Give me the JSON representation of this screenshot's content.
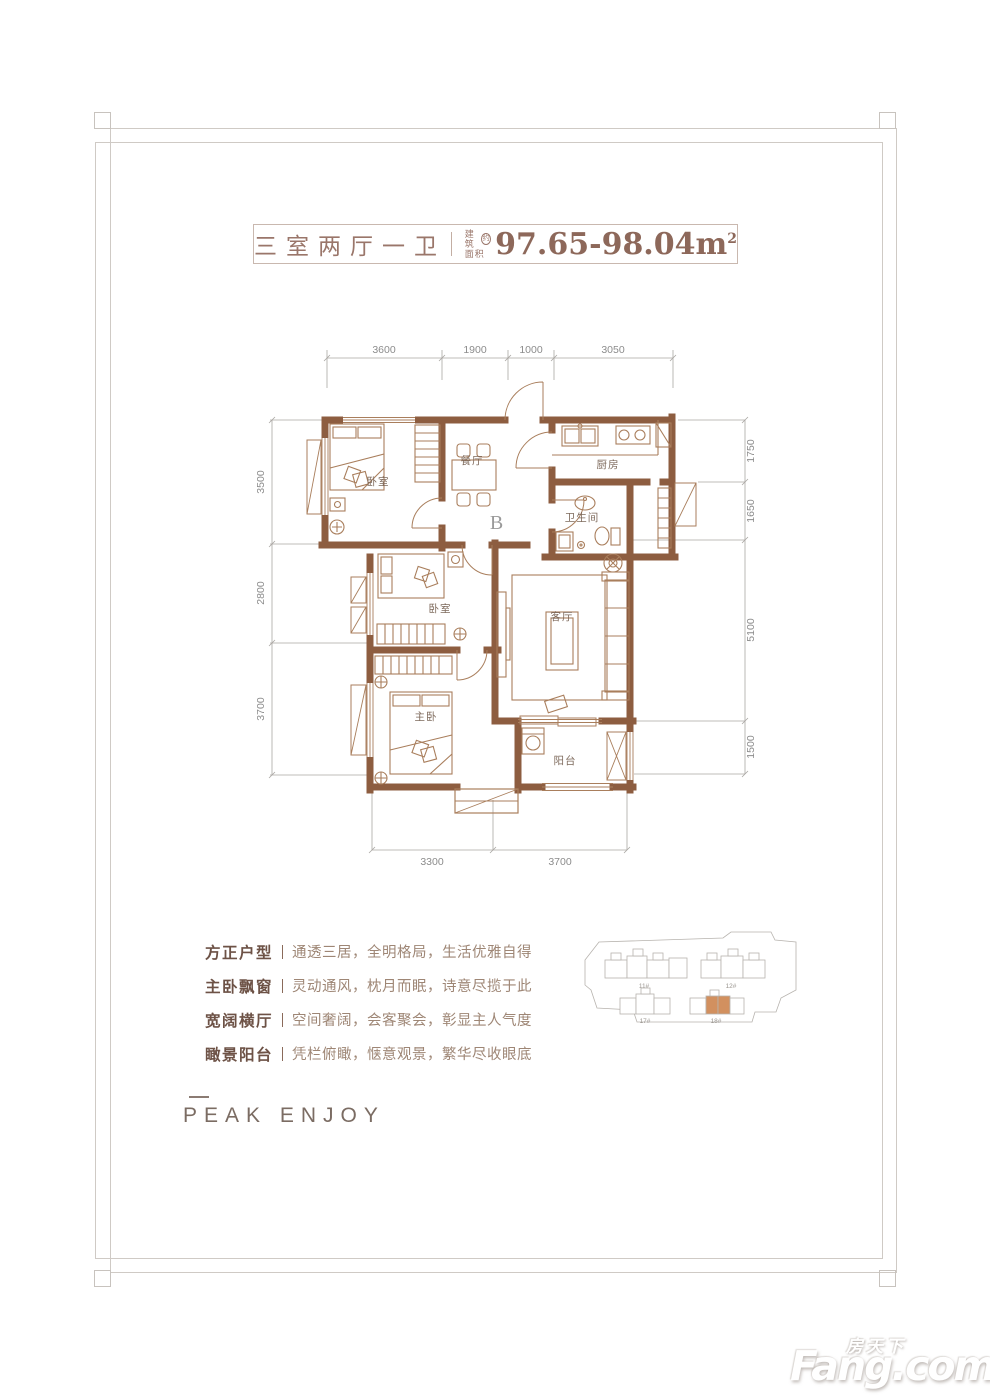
{
  "banner": {
    "title": "三室两厅一卫",
    "area_label_line1": "建筑",
    "area_label_line2": "面积",
    "area_approx": "约",
    "area_value": "97.65-98.04m",
    "area_sup": "2"
  },
  "floorplan": {
    "unit_label": "B",
    "rooms": {
      "bedroom1": "卧室",
      "dining": "餐厅",
      "kitchen": "厨房",
      "bathroom": "卫生间",
      "bedroom2": "卧室",
      "living": "客厅",
      "master": "主卧",
      "balcony": "阳台"
    },
    "dims_top": [
      "3600",
      "1900",
      "1000",
      "3050"
    ],
    "dims_left": [
      "3500",
      "2800",
      "3700"
    ],
    "dims_right": [
      "1750",
      "1650",
      "5100",
      "1500"
    ],
    "dims_bottom": [
      "3300",
      "3700"
    ],
    "wall_color": "#8d5d40"
  },
  "features": [
    {
      "title": "方正户型",
      "desc": "通透三居，全明格局，生活优雅自得"
    },
    {
      "title": "主卧飘窗",
      "desc": "灵动通风，枕月而眠，诗意尽揽于此"
    },
    {
      "title": "宽阔横厅",
      "desc": "空间奢阔，会客聚会，彰显主人气度"
    },
    {
      "title": "瞰景阳台",
      "desc": "凭栏俯瞰，惬意观景，繁华尽收眼底"
    }
  ],
  "brand": "PEAK ENJOY",
  "siteplan": {
    "buildings": [
      {
        "label": "11#",
        "highlighted": false
      },
      {
        "label": "12#",
        "highlighted": false
      },
      {
        "label": "17#",
        "highlighted": false
      },
      {
        "label": "18#",
        "highlighted": true
      }
    ],
    "highlight_color": "#d2905f"
  },
  "watermark": {
    "cn": "房天下",
    "en": "Fang.com"
  }
}
